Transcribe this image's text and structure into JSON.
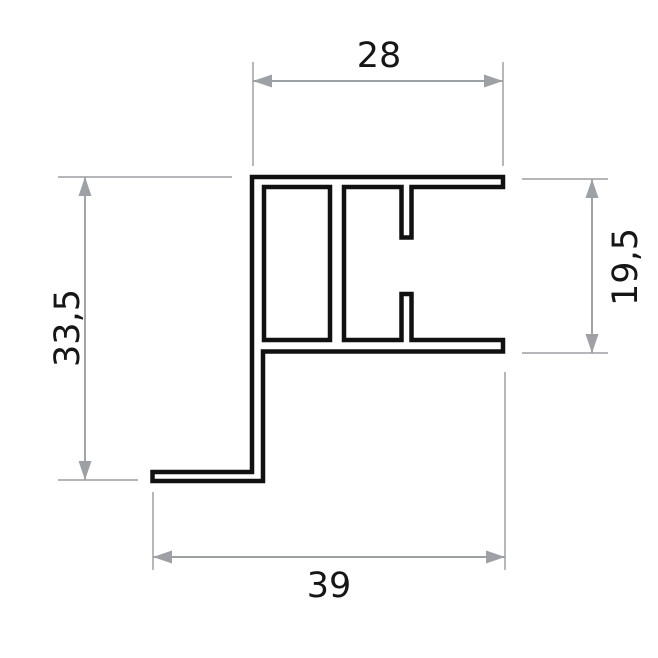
{
  "drawing": {
    "kind": "technical-cross-section",
    "canvas": {
      "width": 658,
      "height": 658
    }
  },
  "colors": {
    "background": "#ffffff",
    "profile-line": "#111111",
    "dim-line": "#9da0a4",
    "ext-line": "#aaacaf",
    "arrow": "#9da0a4",
    "label": "#161616"
  },
  "profile": {
    "outer_path": "M 252,177 H 503 V 187 H 411.5 V 237.5 H 401.5 V 187 H 344 V 340 H 401.5 V 294 H 411.5 V 340 H 503 V 351.5 H 263 V 481 H 152.5 V 472 H 252 Z",
    "chamber_path": "M 264,187 H 330 V 340 H 264 Z"
  },
  "dimensions": [
    {
      "name": "width-top",
      "label": "28",
      "orientation": "horizontal",
      "line": {
        "x1": 253,
        "y1": 81,
        "x2": 503,
        "y2": 81
      },
      "extension_lines": [
        {
          "x1": 253,
          "y1": 62,
          "x2": 253,
          "y2": 166
        },
        {
          "x1": 503,
          "y1": 62,
          "x2": 503,
          "y2": 166
        }
      ],
      "arrows": [
        {
          "x": 253,
          "y": 81,
          "dir": "left"
        },
        {
          "x": 503,
          "y": 81,
          "dir": "right"
        }
      ],
      "label_pos": {
        "x": 379,
        "y": 67,
        "rotate": 0
      }
    },
    {
      "name": "height-right",
      "label": "19,5",
      "orientation": "vertical",
      "line": {
        "x1": 592,
        "y1": 179,
        "x2": 592,
        "y2": 353
      },
      "extension_lines": [
        {
          "x1": 522,
          "y1": 179,
          "x2": 608,
          "y2": 179
        },
        {
          "x1": 522,
          "y1": 353,
          "x2": 608,
          "y2": 353
        }
      ],
      "arrows": [
        {
          "x": 592,
          "y": 179,
          "dir": "up"
        },
        {
          "x": 592,
          "y": 353,
          "dir": "down"
        }
      ],
      "label_pos": {
        "x": 637,
        "y": 267,
        "rotate": -90
      }
    },
    {
      "name": "height-left",
      "label": "33,5",
      "orientation": "vertical",
      "line": {
        "x1": 85,
        "y1": 177,
        "x2": 85,
        "y2": 480
      },
      "extension_lines": [
        {
          "x1": 58,
          "y1": 177,
          "x2": 232,
          "y2": 177
        },
        {
          "x1": 58,
          "y1": 480,
          "x2": 138,
          "y2": 480
        }
      ],
      "arrows": [
        {
          "x": 85,
          "y": 177,
          "dir": "up"
        },
        {
          "x": 85,
          "y": 480,
          "dir": "down"
        }
      ],
      "label_pos": {
        "x": 79,
        "y": 328,
        "rotate": -90
      }
    },
    {
      "name": "width-bottom",
      "label": "39",
      "orientation": "horizontal",
      "line": {
        "x1": 153,
        "y1": 557,
        "x2": 505,
        "y2": 557
      },
      "extension_lines": [
        {
          "x1": 153,
          "y1": 492,
          "x2": 153,
          "y2": 570
        },
        {
          "x1": 505,
          "y1": 372,
          "x2": 505,
          "y2": 570
        }
      ],
      "arrows": [
        {
          "x": 153,
          "y": 557,
          "dir": "left"
        },
        {
          "x": 505,
          "y": 557,
          "dir": "right"
        }
      ],
      "label_pos": {
        "x": 329,
        "y": 597,
        "rotate": 0
      }
    }
  ]
}
